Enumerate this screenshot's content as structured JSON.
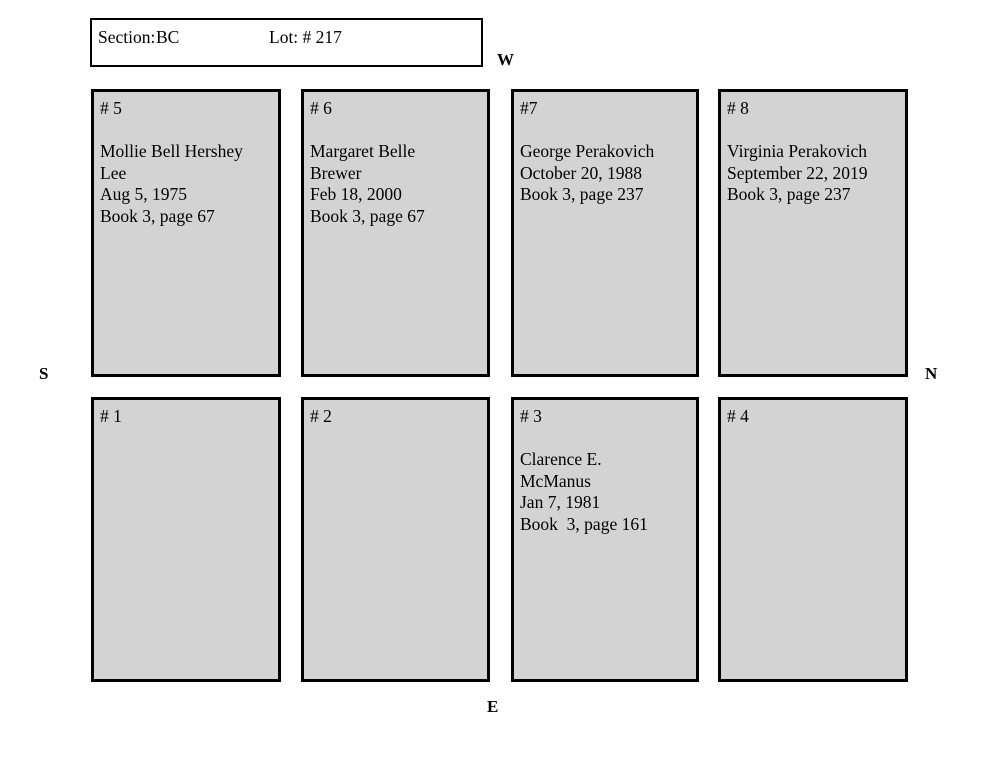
{
  "header": {
    "section_label": "Section:",
    "section_value": "BC",
    "lot_label": "Lot: # 217"
  },
  "compass": {
    "west": "W",
    "south": "S",
    "north": "N",
    "east": "E"
  },
  "plots": {
    "top_row": [
      {
        "number": "# 5",
        "lines": [
          "Mollie Bell Hershey",
          "Lee",
          "Aug 5, 1975",
          "Book 3, page 67"
        ]
      },
      {
        "number": "# 6",
        "lines": [
          "Margaret Belle",
          "Brewer",
          "Feb 18, 2000",
          "Book 3, page 67"
        ]
      },
      {
        "number": "#7",
        "lines": [
          "George Perakovich",
          "October 20, 1988",
          "Book 3, page 237"
        ]
      },
      {
        "number": "# 8",
        "lines": [
          "Virginia Perakovich",
          "September 22, 2019",
          "Book 3, page 237"
        ]
      }
    ],
    "bottom_row": [
      {
        "number": "# 1",
        "lines": []
      },
      {
        "number": "# 2",
        "lines": []
      },
      {
        "number": "# 3",
        "lines": [
          "Clarence E.",
          "McManus",
          "Jan 7, 1981",
          "Book  3, page 161"
        ]
      },
      {
        "number": "# 4",
        "lines": []
      }
    ]
  },
  "colors": {
    "plot_fill": "#d3d3d3",
    "plot_border": "#000000",
    "page_background": "#ffffff",
    "text": "#000000"
  }
}
